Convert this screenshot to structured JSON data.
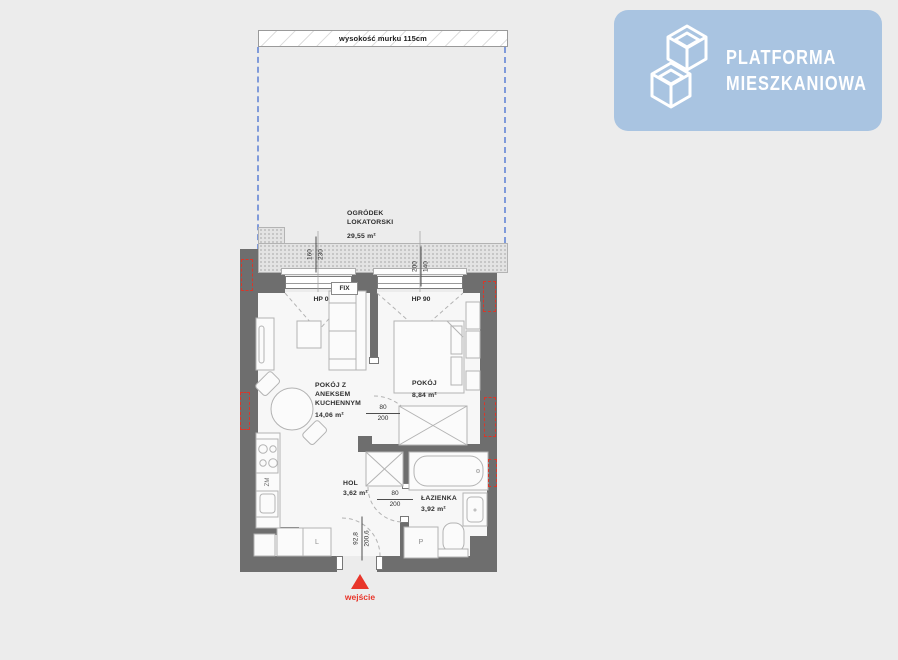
{
  "logo": {
    "line1": "PLATFORMA",
    "line2": "MIESZKANIOWA",
    "icon": "isometric-cubes-icon",
    "bg_color": "#a9c4e1"
  },
  "garden": {
    "wall_note": "wysokość murku 115cm",
    "label_line1": "OGRÓDEK",
    "label_line2": "LOKATORSKI",
    "area": "29,55 m²"
  },
  "rooms": {
    "living": {
      "l1": "POKÓJ Z",
      "l2": "ANEKSEM",
      "l3": "KUCHENNYM",
      "area": "14,06 m²"
    },
    "bedroom": {
      "name": "POKÓJ",
      "area": "8,84 m²"
    },
    "hall": {
      "name": "HOL",
      "area": "3,62 m²"
    },
    "bathroom": {
      "name": "ŁAZIENKA",
      "area": "3,92 m²"
    }
  },
  "windows": {
    "fix": "FIX",
    "hp0": "HP 0",
    "hp90": "HP 90"
  },
  "dims": {
    "win1_a": "160",
    "win1_b": "230",
    "win2_a": "200",
    "win2_b": "140",
    "door_bedroom_a": "80",
    "door_bedroom_b": "200",
    "door_bath_a": "80",
    "door_bath_b": "200",
    "entry_a": "92,8",
    "entry_b": "200,6"
  },
  "appliances": {
    "dishwasher": "ZM",
    "fridge": "L",
    "washer": "P"
  },
  "entrance": {
    "label": "wejście"
  },
  "colors": {
    "accent_red": "#e8352a",
    "marker_red": "#d8372a",
    "dashed_blue": "#7f9ada",
    "wall_gray": "#6e6e6e",
    "logo_bg": "#a9c4e1",
    "background": "#ececec"
  }
}
